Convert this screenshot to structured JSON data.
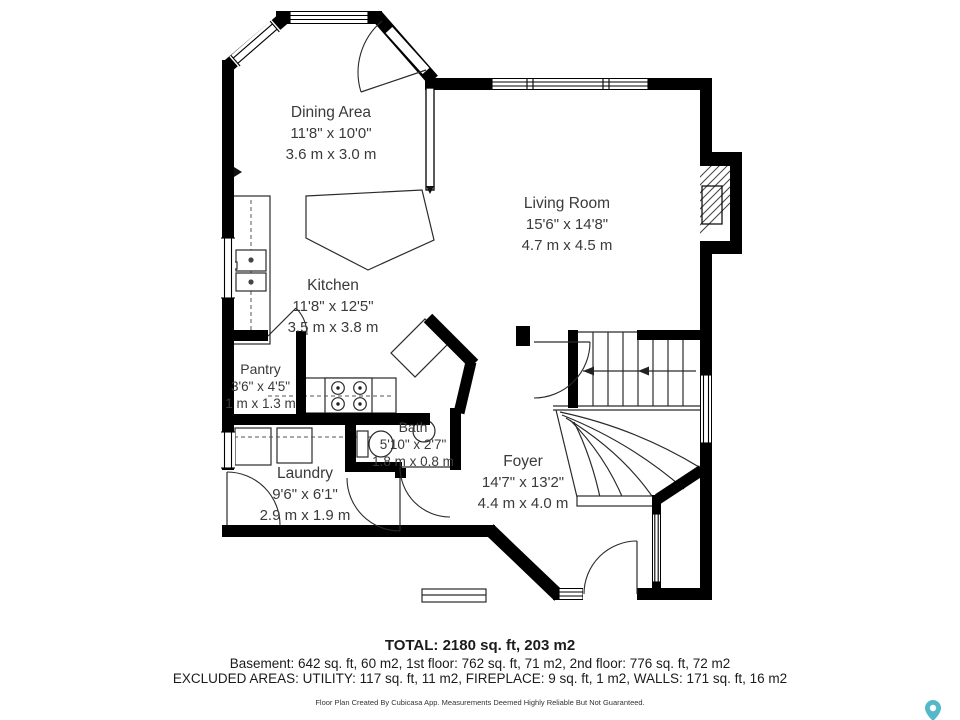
{
  "plan": {
    "rooms": [
      {
        "name": "Dining Area",
        "imperial": "11'8\" x 10'0\"",
        "metric": "3.6 m x 3.0 m"
      },
      {
        "name": "Living Room",
        "imperial": "15'6\" x 14'8\"",
        "metric": "4.7 m x 4.5 m"
      },
      {
        "name": "Kitchen",
        "imperial": "11'8\" x 12'5\"",
        "metric": "3.5 m x 3.8 m"
      },
      {
        "name": "Pantry",
        "imperial": "3'6\" x 4'5\"",
        "metric": "1 m x 1.3 m"
      },
      {
        "name": "Bath",
        "imperial": "5'10\" x 2'7\"",
        "metric": "1.8 m x 0.8 m"
      },
      {
        "name": "Laundry",
        "imperial": "9'6\" x 6'1\"",
        "metric": "2.9 m x 1.9 m"
      },
      {
        "name": "Foyer",
        "imperial": "14'7\" x 13'2\"",
        "metric": "4.4 m x 4.0 m"
      }
    ],
    "summary": {
      "total": "TOTAL: 2180 sq. ft, 203 m2",
      "floors": "Basement: 642 sq. ft, 60 m2, 1st floor: 762 sq. ft, 71 m2, 2nd floor: 776 sq. ft, 72 m2",
      "excluded": "EXCLUDED AREAS: UTILITY: 117 sq. ft, 11 m2, FIREPLACE: 9 sq. ft, 1 m2, WALLS: 171 sq. ft, 16 m2",
      "disclaimer": "Floor Plan Created By Cubicasa App. Measurements Deemed Highly Reliable But Not Guaranteed."
    },
    "colors": {
      "wall": "#000000",
      "logo_teal": "#55b8c8"
    }
  }
}
